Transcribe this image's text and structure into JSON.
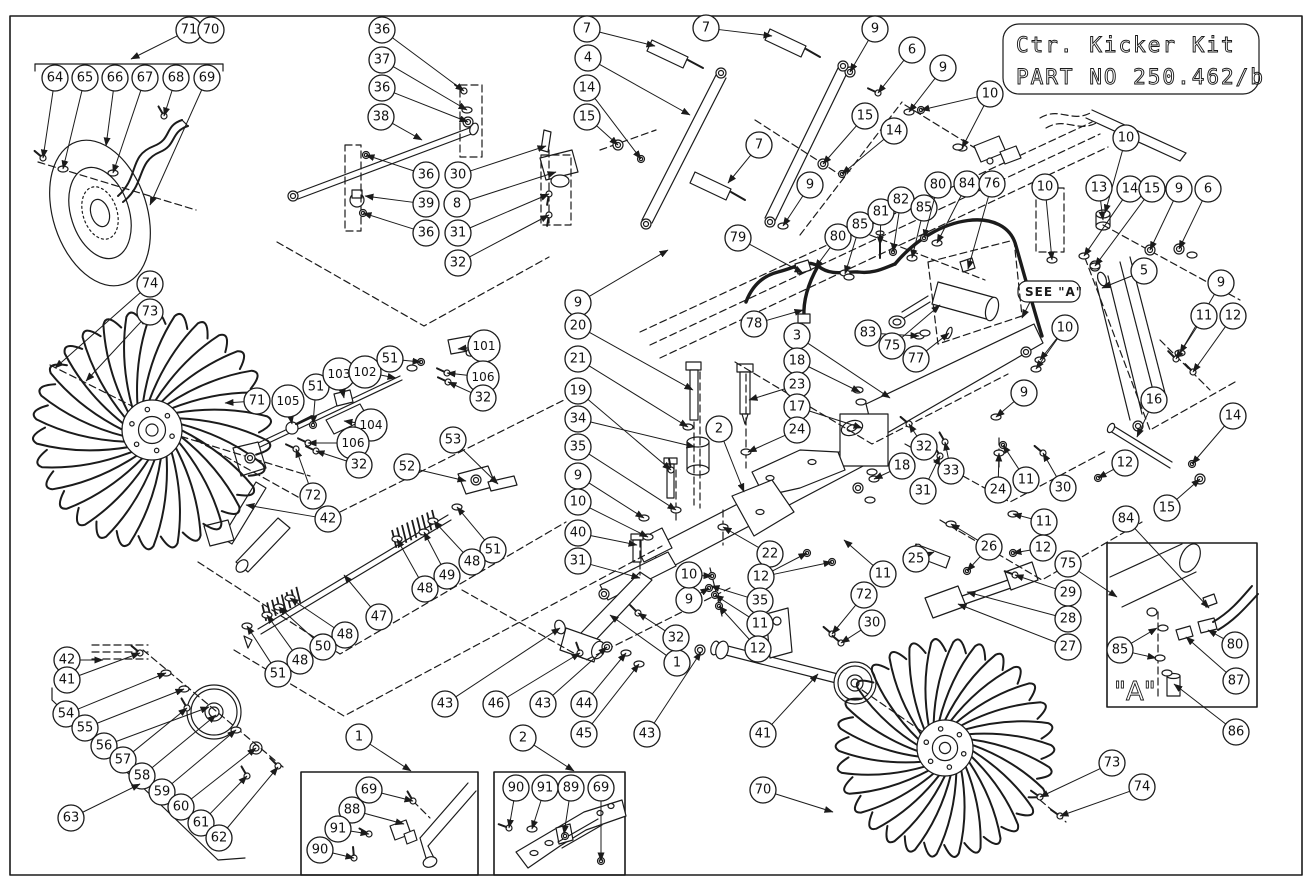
{
  "title_block": {
    "line1": "Ctr. Kicker Kit",
    "line2": "PART NO 250.462/b"
  },
  "labels": {
    "see_a": "SEE \"A\"",
    "detail_a": "\"A\""
  },
  "balloons": [
    {
      "n": "71",
      "x": 189,
      "y": 30,
      "t": [
        131,
        59
      ]
    },
    {
      "n": "70",
      "x": 211,
      "y": 30
    },
    {
      "n": "64",
      "x": 55,
      "y": 78,
      "t": [
        43,
        158
      ]
    },
    {
      "n": "65",
      "x": 85,
      "y": 78,
      "t": [
        63,
        169
      ]
    },
    {
      "n": "66",
      "x": 115,
      "y": 78,
      "t": [
        106,
        146
      ]
    },
    {
      "n": "67",
      "x": 145,
      "y": 78,
      "t": [
        113,
        173
      ]
    },
    {
      "n": "68",
      "x": 176,
      "y": 78,
      "t": [
        164,
        116
      ]
    },
    {
      "n": "69",
      "x": 207,
      "y": 78,
      "t": [
        150,
        205
      ]
    },
    {
      "n": "36",
      "x": 382,
      "y": 30,
      "t": [
        464,
        91
      ]
    },
    {
      "n": "37",
      "x": 382,
      "y": 60,
      "t": [
        467,
        110
      ]
    },
    {
      "n": "36",
      "x": 382,
      "y": 88,
      "t": [
        468,
        122
      ]
    },
    {
      "n": "38",
      "x": 381,
      "y": 117,
      "t": [
        422,
        140
      ]
    },
    {
      "n": "36",
      "x": 426,
      "y": 175,
      "t": [
        366,
        155
      ]
    },
    {
      "n": "39",
      "x": 426,
      "y": 204,
      "t": [
        365,
        196
      ]
    },
    {
      "n": "36",
      "x": 426,
      "y": 233,
      "t": [
        363,
        213
      ]
    },
    {
      "n": "30",
      "x": 458,
      "y": 175,
      "t": [
        546,
        146
      ]
    },
    {
      "n": "8",
      "x": 457,
      "y": 204,
      "t": [
        556,
        172
      ]
    },
    {
      "n": "31",
      "x": 458,
      "y": 233,
      "t": [
        549,
        194
      ]
    },
    {
      "n": "32",
      "x": 458,
      "y": 263,
      "t": [
        549,
        215
      ]
    },
    {
      "n": "7",
      "x": 587,
      "y": 29,
      "t": [
        655,
        46
      ]
    },
    {
      "n": "7",
      "x": 706,
      "y": 28,
      "t": [
        772,
        36
      ]
    },
    {
      "n": "9",
      "x": 875,
      "y": 29,
      "t": [
        850,
        72
      ]
    },
    {
      "n": "4",
      "x": 588,
      "y": 58,
      "t": [
        690,
        115
      ]
    },
    {
      "n": "14",
      "x": 587,
      "y": 88,
      "t": [
        641,
        159
      ]
    },
    {
      "n": "15",
      "x": 587,
      "y": 117,
      "t": [
        618,
        145
      ]
    },
    {
      "n": "7",
      "x": 759,
      "y": 145,
      "t": [
        728,
        183
      ]
    },
    {
      "n": "9",
      "x": 810,
      "y": 185,
      "t": [
        783,
        226
      ]
    },
    {
      "n": "15",
      "x": 865,
      "y": 116,
      "t": [
        823,
        164
      ]
    },
    {
      "n": "14",
      "x": 894,
      "y": 131,
      "t": [
        842,
        174
      ]
    },
    {
      "n": "6",
      "x": 912,
      "y": 50,
      "t": [
        878,
        93
      ]
    },
    {
      "n": "9",
      "x": 943,
      "y": 68,
      "t": [
        909,
        112
      ]
    },
    {
      "n": "10",
      "x": 990,
      "y": 94,
      "t": [
        921,
        110
      ],
      "t2": [
        962,
        148
      ]
    },
    {
      "n": "79",
      "x": 738,
      "y": 238,
      "t": [
        803,
        273
      ]
    },
    {
      "n": "80",
      "x": 838,
      "y": 237,
      "t": [
        815,
        268
      ]
    },
    {
      "n": "85",
      "x": 860,
      "y": 225,
      "t": [
        845,
        274
      ]
    },
    {
      "n": "81",
      "x": 881,
      "y": 212,
      "t": [
        880,
        245
      ]
    },
    {
      "n": "82",
      "x": 901,
      "y": 200,
      "t": [
        893,
        252
      ]
    },
    {
      "n": "85",
      "x": 924,
      "y": 208,
      "t": [
        912,
        258
      ]
    },
    {
      "n": "80",
      "x": 938,
      "y": 185,
      "t": [
        924,
        238
      ]
    },
    {
      "n": "84",
      "x": 967,
      "y": 184,
      "t": [
        937,
        243
      ]
    },
    {
      "n": "76",
      "x": 992,
      "y": 184,
      "t": [
        968,
        269
      ]
    },
    {
      "n": "10",
      "x": 1126,
      "y": 138,
      "t": [
        1105,
        213
      ]
    },
    {
      "n": "13",
      "x": 1099,
      "y": 188,
      "t": [
        1103,
        220
      ]
    },
    {
      "n": "14",
      "x": 1130,
      "y": 189,
      "t": [
        1084,
        256
      ]
    },
    {
      "n": "15",
      "x": 1152,
      "y": 189,
      "t": [
        1095,
        266
      ]
    },
    {
      "n": "9",
      "x": 1179,
      "y": 189,
      "t": [
        1150,
        250
      ]
    },
    {
      "n": "6",
      "x": 1208,
      "y": 189,
      "t": [
        1179,
        249
      ]
    },
    {
      "n": "10",
      "x": 1045,
      "y": 187,
      "t": [
        1052,
        260
      ]
    },
    {
      "n": "5",
      "x": 1144,
      "y": 271,
      "t": [
        1102,
        288
      ]
    },
    {
      "n": "9",
      "x": 1221,
      "y": 283,
      "t": [
        1180,
        353
      ]
    },
    {
      "n": "11",
      "x": 1204,
      "y": 316,
      "t": [
        1176,
        359
      ]
    },
    {
      "n": "12",
      "x": 1233,
      "y": 316,
      "t": [
        1193,
        372
      ]
    },
    {
      "n": "16",
      "x": 1154,
      "y": 400,
      "t": [
        1137,
        437
      ]
    },
    {
      "n": "14",
      "x": 1233,
      "y": 416,
      "t": [
        1192,
        464
      ]
    },
    {
      "n": "12",
      "x": 1125,
      "y": 463,
      "t": [
        1098,
        478
      ]
    },
    {
      "n": "15",
      "x": 1167,
      "y": 508,
      "t": [
        1200,
        479
      ]
    },
    {
      "n": "78",
      "x": 754,
      "y": 324,
      "t": [
        803,
        310
      ]
    },
    {
      "n": "3",
      "x": 797,
      "y": 336,
      "t": [
        890,
        398
      ]
    },
    {
      "n": "18",
      "x": 797,
      "y": 361,
      "t": [
        860,
        392
      ]
    },
    {
      "n": "23",
      "x": 797,
      "y": 385,
      "t": [
        749,
        400
      ]
    },
    {
      "n": "17",
      "x": 797,
      "y": 407,
      "t": [
        862,
        428
      ]
    },
    {
      "n": "24",
      "x": 797,
      "y": 430,
      "t": [
        748,
        452
      ]
    },
    {
      "n": "2",
      "x": 719,
      "y": 429,
      "t": [
        744,
        492
      ]
    },
    {
      "n": "9",
      "x": 578,
      "y": 303,
      "t": [
        668,
        250
      ]
    },
    {
      "n": "20",
      "x": 578,
      "y": 326,
      "t": [
        693,
        390
      ]
    },
    {
      "n": "21",
      "x": 578,
      "y": 359,
      "t": [
        688,
        427
      ]
    },
    {
      "n": "19",
      "x": 578,
      "y": 391,
      "t": [
        671,
        470
      ]
    },
    {
      "n": "34",
      "x": 578,
      "y": 419,
      "t": [
        695,
        447
      ]
    },
    {
      "n": "35",
      "x": 578,
      "y": 447,
      "t": [
        676,
        510
      ]
    },
    {
      "n": "9",
      "x": 578,
      "y": 476,
      "t": [
        644,
        518
      ]
    },
    {
      "n": "10",
      "x": 578,
      "y": 502,
      "t": [
        648,
        537
      ]
    },
    {
      "n": "40",
      "x": 578,
      "y": 533,
      "t": [
        637,
        545
      ]
    },
    {
      "n": "31",
      "x": 578,
      "y": 561,
      "t": [
        640,
        578
      ]
    },
    {
      "n": "83",
      "x": 868,
      "y": 333,
      "t": [
        919,
        336
      ]
    },
    {
      "n": "75",
      "x": 892,
      "y": 346,
      "t": [
        940,
        305
      ]
    },
    {
      "n": "77",
      "x": 916,
      "y": 359,
      "t": [
        949,
        333
      ]
    },
    {
      "n": "10",
      "x": 1065,
      "y": 328,
      "t": [
        1040,
        360
      ],
      "t2": [
        1036,
        369
      ]
    },
    {
      "n": "9",
      "x": 1024,
      "y": 393,
      "t": [
        996,
        417
      ]
    },
    {
      "n": "18",
      "x": 902,
      "y": 466,
      "t": [
        874,
        479
      ]
    },
    {
      "n": "32",
      "x": 924,
      "y": 447,
      "t": [
        909,
        424
      ]
    },
    {
      "n": "33",
      "x": 951,
      "y": 471,
      "t": [
        945,
        442
      ]
    },
    {
      "n": "31",
      "x": 923,
      "y": 491,
      "t": [
        940,
        456
      ]
    },
    {
      "n": "25",
      "x": 916,
      "y": 559,
      "t": [
        934,
        552
      ]
    },
    {
      "n": "26",
      "x": 989,
      "y": 547,
      "t": [
        951,
        524
      ],
      "t2": [
        967,
        571
      ]
    },
    {
      "n": "24",
      "x": 998,
      "y": 490,
      "t": [
        999,
        453
      ]
    },
    {
      "n": "11",
      "x": 1026,
      "y": 480,
      "t": [
        1003,
        445
      ]
    },
    {
      "n": "30",
      "x": 1063,
      "y": 488,
      "t": [
        1043,
        453
      ]
    },
    {
      "n": "11",
      "x": 1044,
      "y": 522,
      "t": [
        1013,
        514
      ]
    },
    {
      "n": "12",
      "x": 1043,
      "y": 548,
      "t": [
        1013,
        553
      ]
    },
    {
      "n": "75",
      "x": 1068,
      "y": 564,
      "t": [
        1117,
        597
      ]
    },
    {
      "n": "29",
      "x": 1068,
      "y": 593,
      "t": [
        1015,
        575
      ]
    },
    {
      "n": "28",
      "x": 1068,
      "y": 619,
      "t": [
        967,
        592
      ]
    },
    {
      "n": "27",
      "x": 1068,
      "y": 647,
      "t": [
        958,
        604
      ]
    },
    {
      "n": "84",
      "x": 1126,
      "y": 519,
      "t": [
        1209,
        608
      ]
    },
    {
      "n": "85",
      "x": 1120,
      "y": 650,
      "t": [
        1157,
        628
      ],
      "t2": [
        1156,
        658
      ]
    },
    {
      "n": "80",
      "x": 1235,
      "y": 645,
      "t": [
        1208,
        630
      ]
    },
    {
      "n": "87",
      "x": 1236,
      "y": 681,
      "t": [
        1186,
        637
      ]
    },
    {
      "n": "86",
      "x": 1236,
      "y": 732,
      "t": [
        1174,
        684
      ]
    },
    {
      "n": "73",
      "x": 1112,
      "y": 763,
      "t": [
        1040,
        797
      ]
    },
    {
      "n": "74",
      "x": 1142,
      "y": 787,
      "t": [
        1060,
        816
      ]
    },
    {
      "n": "70",
      "x": 763,
      "y": 790,
      "t": [
        833,
        812
      ]
    },
    {
      "n": "41",
      "x": 763,
      "y": 734,
      "t": [
        818,
        674
      ]
    },
    {
      "n": "43",
      "x": 647,
      "y": 734,
      "t": [
        701,
        652
      ]
    },
    {
      "n": "43",
      "x": 445,
      "y": 704,
      "t": [
        560,
        628
      ]
    },
    {
      "n": "46",
      "x": 496,
      "y": 704,
      "t": [
        580,
        653
      ]
    },
    {
      "n": "43",
      "x": 543,
      "y": 704,
      "t": [
        607,
        647
      ]
    },
    {
      "n": "44",
      "x": 584,
      "y": 704,
      "t": [
        626,
        653
      ]
    },
    {
      "n": "45",
      "x": 584,
      "y": 734,
      "t": [
        639,
        664
      ]
    },
    {
      "n": "1",
      "x": 677,
      "y": 663,
      "t": [
        610,
        615
      ]
    },
    {
      "n": "32",
      "x": 676,
      "y": 638,
      "t": [
        638,
        613
      ]
    },
    {
      "n": "9",
      "x": 689,
      "y": 600,
      "t": [
        709,
        588
      ]
    },
    {
      "n": "10",
      "x": 689,
      "y": 575,
      "t": [
        712,
        576
      ]
    },
    {
      "n": "22",
      "x": 770,
      "y": 554,
      "t": [
        723,
        527
      ]
    },
    {
      "n": "12",
      "x": 761,
      "y": 577,
      "t": [
        807,
        553
      ],
      "t2": [
        832,
        562
      ]
    },
    {
      "n": "35",
      "x": 760,
      "y": 601,
      "t": [
        711,
        586
      ]
    },
    {
      "n": "11",
      "x": 760,
      "y": 624,
      "t": [
        715,
        595
      ]
    },
    {
      "n": "12",
      "x": 758,
      "y": 649,
      "t": [
        719,
        606
      ]
    },
    {
      "n": "11",
      "x": 883,
      "y": 574,
      "t": [
        844,
        540
      ]
    },
    {
      "n": "72",
      "x": 864,
      "y": 595,
      "t": [
        832,
        634
      ]
    },
    {
      "n": "30",
      "x": 872,
      "y": 623,
      "t": [
        841,
        643
      ]
    },
    {
      "n": "1",
      "x": 359,
      "y": 737,
      "t": [
        411,
        771
      ]
    },
    {
      "n": "2",
      "x": 523,
      "y": 738,
      "t": [
        574,
        771
      ]
    },
    {
      "n": "69",
      "x": 369,
      "y": 790,
      "t": [
        413,
        801
      ]
    },
    {
      "n": "88",
      "x": 352,
      "y": 810,
      "t": [
        404,
        824
      ]
    },
    {
      "n": "91",
      "x": 338,
      "y": 829,
      "t": [
        369,
        834
      ]
    },
    {
      "n": "90",
      "x": 320,
      "y": 850,
      "t": [
        354,
        858
      ]
    },
    {
      "n": "90",
      "x": 516,
      "y": 788,
      "t": [
        509,
        828
      ]
    },
    {
      "n": "91",
      "x": 545,
      "y": 788,
      "t": [
        532,
        829
      ]
    },
    {
      "n": "89",
      "x": 571,
      "y": 788,
      "t": [
        564,
        834
      ]
    },
    {
      "n": "69",
      "x": 601,
      "y": 788,
      "t": [
        601,
        861
      ]
    },
    {
      "n": "42",
      "x": 67,
      "y": 660,
      "t": [
        103,
        660
      ]
    },
    {
      "n": "41",
      "x": 67,
      "y": 680,
      "t": [
        140,
        653
      ]
    },
    {
      "n": "54",
      "x": 66,
      "y": 714,
      "t": [
        166,
        673
      ]
    },
    {
      "n": "55",
      "x": 85,
      "y": 728,
      "t": [
        184,
        689
      ]
    },
    {
      "n": "56",
      "x": 104,
      "y": 746,
      "t": [
        209,
        707
      ]
    },
    {
      "n": "57",
      "x": 123,
      "y": 760,
      "t": [
        187,
        708
      ]
    },
    {
      "n": "58",
      "x": 142,
      "y": 776,
      "t": [
        216,
        715
      ]
    },
    {
      "n": "59",
      "x": 162,
      "y": 792,
      "t": [
        236,
        730
      ]
    },
    {
      "n": "60",
      "x": 181,
      "y": 807,
      "t": [
        256,
        748
      ]
    },
    {
      "n": "61",
      "x": 201,
      "y": 823,
      "t": [
        247,
        776
      ]
    },
    {
      "n": "62",
      "x": 219,
      "y": 838,
      "t": [
        278,
        767
      ]
    },
    {
      "n": "63",
      "x": 71,
      "y": 818,
      "t": [
        140,
        784
      ]
    },
    {
      "n": "74",
      "x": 150,
      "y": 284,
      "t": [
        55,
        368
      ]
    },
    {
      "n": "73",
      "x": 150,
      "y": 312,
      "t": [
        86,
        381
      ]
    },
    {
      "n": "71",
      "x": 257,
      "y": 401,
      "t": [
        225,
        403
      ]
    },
    {
      "n": "105",
      "x": 288,
      "y": 401,
      "t": [
        292,
        424
      ]
    },
    {
      "n": "51",
      "x": 316,
      "y": 387,
      "t": [
        313,
        424
      ]
    },
    {
      "n": "103",
      "x": 339,
      "y": 374,
      "t": [
        344,
        398
      ]
    },
    {
      "n": "102",
      "x": 365,
      "y": 372,
      "t": [
        396,
        378
      ]
    },
    {
      "n": "51",
      "x": 390,
      "y": 359,
      "t": [
        421,
        362
      ]
    },
    {
      "n": "101",
      "x": 484,
      "y": 346,
      "t": [
        458,
        349
      ]
    },
    {
      "n": "106",
      "x": 483,
      "y": 377,
      "t": [
        447,
        373
      ]
    },
    {
      "n": "32",
      "x": 483,
      "y": 398,
      "t": [
        448,
        382
      ]
    },
    {
      "n": "104",
      "x": 371,
      "y": 425,
      "t": [
        344,
        421
      ]
    },
    {
      "n": "106",
      "x": 353,
      "y": 443,
      "t": [
        308,
        443
      ]
    },
    {
      "n": "32",
      "x": 359,
      "y": 465,
      "t": [
        316,
        451
      ]
    },
    {
      "n": "72",
      "x": 313,
      "y": 496,
      "t": [
        296,
        449
      ]
    },
    {
      "n": "42",
      "x": 328,
      "y": 519,
      "t": [
        246,
        505
      ]
    },
    {
      "n": "53",
      "x": 453,
      "y": 440,
      "t": [
        498,
        484
      ]
    },
    {
      "n": "52",
      "x": 407,
      "y": 467,
      "t": [
        466,
        481
      ]
    },
    {
      "n": "51",
      "x": 493,
      "y": 550,
      "t": [
        457,
        507
      ]
    },
    {
      "n": "48",
      "x": 472,
      "y": 562,
      "t": [
        434,
        521
      ]
    },
    {
      "n": "49",
      "x": 447,
      "y": 576,
      "t": [
        424,
        532
      ]
    },
    {
      "n": "48",
      "x": 425,
      "y": 589,
      "t": [
        397,
        539
      ]
    },
    {
      "n": "47",
      "x": 379,
      "y": 617,
      "t": [
        344,
        575
      ]
    },
    {
      "n": "48",
      "x": 345,
      "y": 635,
      "t": [
        290,
        598
      ]
    },
    {
      "n": "50",
      "x": 323,
      "y": 647,
      "t": [
        279,
        607
      ]
    },
    {
      "n": "48",
      "x": 300,
      "y": 661,
      "t": [
        267,
        615
      ]
    },
    {
      "n": "51",
      "x": 278,
      "y": 674,
      "t": [
        247,
        626
      ]
    }
  ]
}
